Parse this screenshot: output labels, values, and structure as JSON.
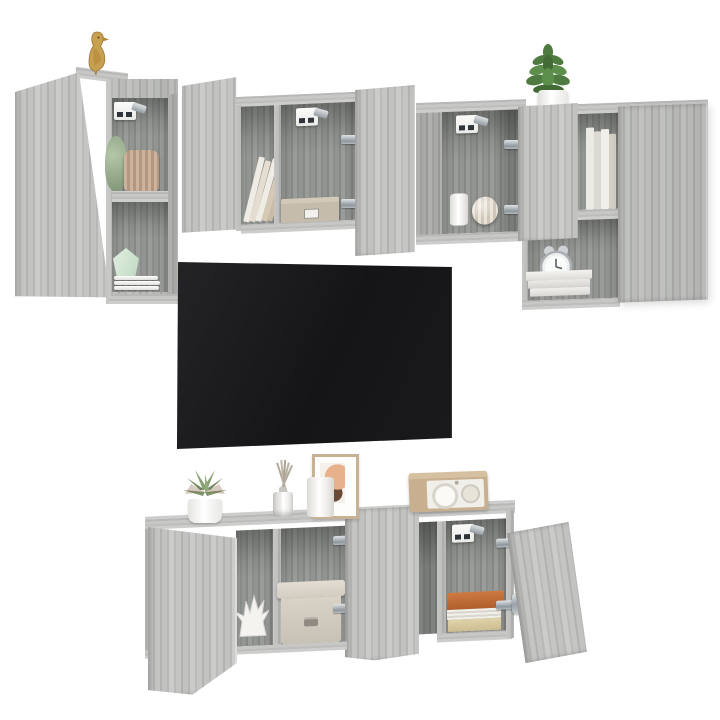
{
  "image": {
    "type": "product-photo",
    "subject": "6-piece wall-mounted TV media wall unit in grey sonoma oak, doors open, styled with decor, flat-screen TV on wall",
    "background_color": "#ffffff",
    "visible_text": ""
  },
  "palette": {
    "wood_face": "#bcbdbb",
    "wood_grain_dark": "#a7a8a6",
    "wood_top": "#c9cac8",
    "wood_interior": "#8d8f8d",
    "tv_screen": "#1a1a1d",
    "hinge_metal": "#aab2b8",
    "bracket_white": "#f6f6f4",
    "bird_gold": "#c49a4a",
    "plant_green": "#4e7b3f",
    "succulent_green": "#7e9468",
    "sage_vase": "#9cb192",
    "mint_vase": "#d6e8d7",
    "pleated_fan_tan": "#c2a68c",
    "drawer_box_beige": "#c6bcab",
    "fabric_box_greige": "#d7d0c5",
    "coral_white": "#f4f3f0",
    "book_orange": "#bf6a37",
    "book_beige": "#d8c9a3",
    "radio_beige": "#c8af90",
    "frame_tan": "#c8b295",
    "art_peach": "#e7b28b"
  },
  "scene": {
    "tv": {
      "label": "flat-screen TV mounted on wall, screen off"
    },
    "upper_left_cabinet": {
      "label": "tall wall cabinet with open door and two open shelves"
    },
    "upper_middle_cabinet": {
      "label": "double wall cabinet with both doors open"
    },
    "upper_right_cabinet": {
      "label": "wall cabinet stack with open door and tall closed door"
    },
    "lower_sideboard": {
      "label": "floating TV sideboard with three open doors"
    },
    "decor": {
      "bird": "gold bird figurine",
      "plant": "green plant in white pot",
      "sage_vase": "sage green vase",
      "pleated_fan": "pleated fan ornament",
      "mint_vase": "mint faceted vase",
      "plates": "stack of white plates",
      "leaning_books": "books leaning in cubby",
      "drawer_box": "small beige drawer box",
      "wall_bracket": "white wall-mount bracket",
      "white_cup": "white cup",
      "ribbed_sphere": "ribbed sphere vase",
      "standing_books": "white standing books",
      "alarm_clock": "retro twin-bell alarm clock",
      "white_book_stack": "stack of white books",
      "succulent": "succulent in white pot",
      "diffuser": "reed diffuser",
      "candle": "white pillar candle",
      "picture_frame": "framed abstract picture",
      "radio": "vintage beige radio",
      "coral": "white coral ornament",
      "fabric_box": "fabric storage box with lid",
      "book_stack_lower": "stack of orange, white and beige books",
      "hinges": "soft-close cabinet hinges"
    }
  }
}
